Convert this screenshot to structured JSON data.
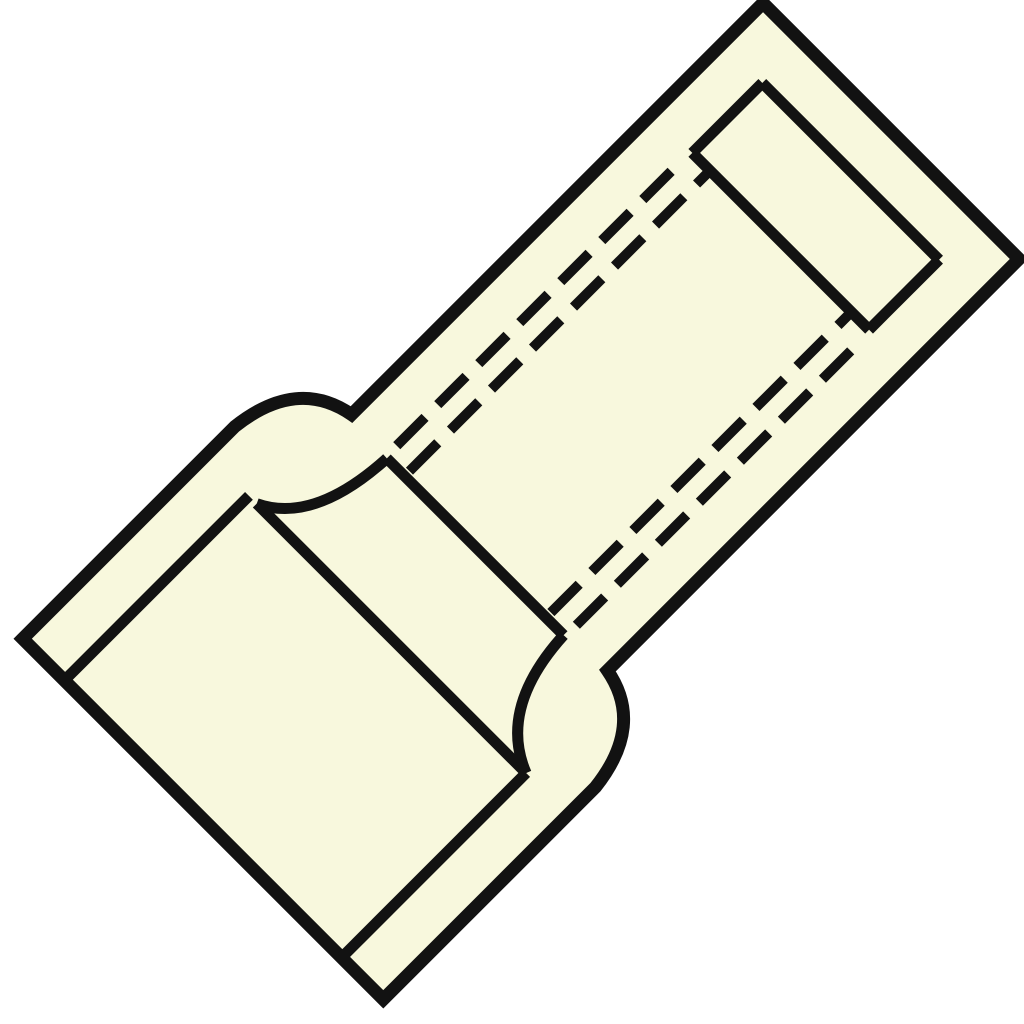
{
  "canvas": {
    "width": 1024,
    "height": 1024,
    "background": "#ffffff"
  },
  "drawing": {
    "name": "butt-splice-connector-line-art",
    "description": "Diagonal technical line drawing of a reducing press/butt connector: wide barrel lower-left, narrow barrel upper-right, collar transition, hidden bore shown dashed",
    "fill_color": "#f8f8dd",
    "stroke_color": "#121212",
    "transform": {
      "translate": [
        512,
        510
      ],
      "rotate_deg": -45
    },
    "stroke_widths": {
      "outline": 13,
      "inner": 11,
      "dashed": 10
    },
    "dash_pattern": [
      40,
      18
    ],
    "outline_path": "M -46 -181 L 536 -181 L 536 181 L -46 181 Q -58 246 -137 255 L -437 255 L -437 -255 L -137 -255 Q -58 -246 -46 -181 Z",
    "inner_lines": [
      {
        "name": "small-end-inner-edge",
        "path": "M 479 -125 L 479 125"
      },
      {
        "name": "small-end-bore-top",
        "path": "M 380 -125 L 479 -125"
      },
      {
        "name": "small-end-bore-bottom",
        "path": "M 380 125 L 479 125"
      },
      {
        "name": "small-end-bore-back",
        "path": "M 380 -125 L 380 125"
      },
      {
        "name": "crimp-stop-right-edge",
        "path": "M -52 -125 L -52 125"
      },
      {
        "name": "crimp-stop-left-edge",
        "path": "M -176 -185 L -176 196"
      },
      {
        "name": "stop-fillet-top",
        "path": "M -52 -125 Q -150 -130 -176 -185"
      },
      {
        "name": "stop-fillet-bottom",
        "path": "M -52 125 Q -150 130 -176 196"
      },
      {
        "name": "large-bore-top-edge",
        "path": "M -437 -196 L -176 -196"
      },
      {
        "name": "large-bore-bottom-edge",
        "path": "M -437 196 L -176 196"
      }
    ],
    "dashed_lines": [
      {
        "name": "hidden-bore-line-upper-outer",
        "path": "M 352 -127 L -52 -127",
        "dash_offset": 0
      },
      {
        "name": "hidden-bore-line-upper-inner",
        "path": "M 376 -100 L -52 -100",
        "dash_offset": 25
      },
      {
        "name": "hidden-bore-line-lower-outer",
        "path": "M 352 127 L -52 127",
        "dash_offset": 0
      },
      {
        "name": "hidden-bore-line-lower-inner",
        "path": "M 376 100 L -52 100",
        "dash_offset": 25
      }
    ]
  }
}
